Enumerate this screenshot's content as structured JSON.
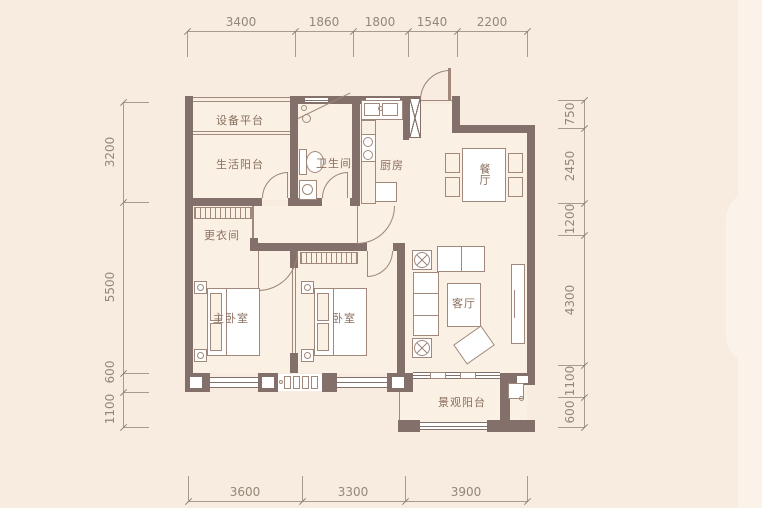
{
  "colors": {
    "background": "#f7ecdf",
    "panel_light": "#fbf3e9",
    "wall": "#84706a",
    "furniture_line": "#a0897a",
    "dim_line": "#a89a8c",
    "dim_text": "#93877a",
    "label_text": "#8a6f5f",
    "floor": "#faf1e4"
  },
  "rooms": {
    "equipment_platform": {
      "label": "设备平台"
    },
    "service_balcony": {
      "label": "生活阳台"
    },
    "bathroom": {
      "label": "卫生间"
    },
    "kitchen": {
      "label": "厨房"
    },
    "dining": {
      "label": "餐厅"
    },
    "dressing_room": {
      "label": "更衣间"
    },
    "master_bedroom": {
      "label": "主卧室"
    },
    "bedroom": {
      "label": "卧室"
    },
    "living_room": {
      "label": "客厅"
    },
    "view_balcony": {
      "label": "景观阳台"
    }
  },
  "dimensions": {
    "top": [
      "3400",
      "1860",
      "1800",
      "1540",
      "2200"
    ],
    "bottom": [
      "3600",
      "3300",
      "3900"
    ],
    "left": [
      "3200",
      "5500",
      "600",
      "1100"
    ],
    "right": [
      "750",
      "2450",
      "1200",
      "4300",
      "1100",
      "600"
    ]
  }
}
